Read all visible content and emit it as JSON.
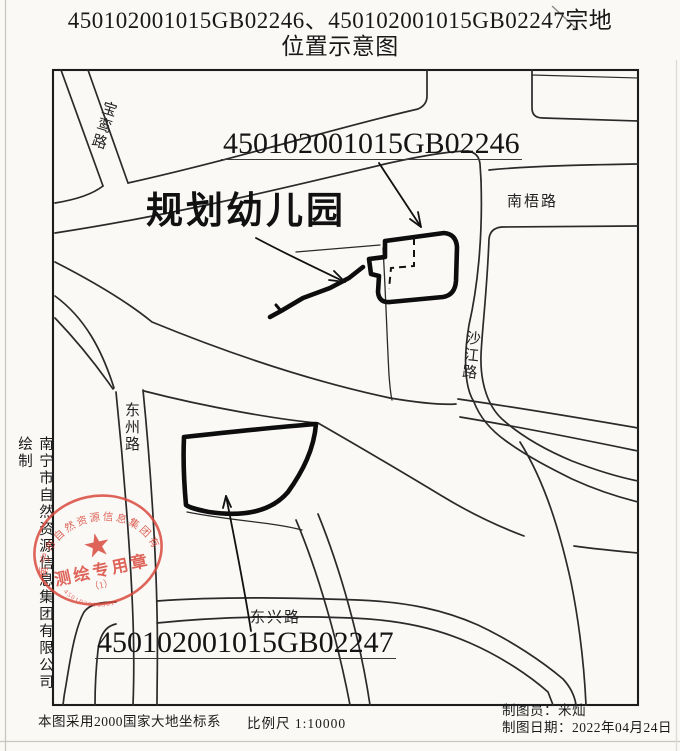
{
  "colors": {
    "ink": "#1f1f1f",
    "seal_red": "#d9473b",
    "paper": "#faf9f6"
  },
  "title": {
    "line1": "450102001015GB02246、450102001015GB02247宗地",
    "line2": "位置示意图"
  },
  "map": {
    "labels": {
      "parcel1": "450102001015GB02246",
      "kindergarten": "规划幼儿园",
      "parcel2": "450102001015GB02247"
    },
    "roads": {
      "baoluan": "宝鸾路",
      "nanwu": "南梧路",
      "shajiang": "沙江路",
      "dongzhou": "东州路",
      "dongxing": "东兴路"
    }
  },
  "seal": {
    "company": "南宁市自然资源信息集团有限公司",
    "caption": "测绘专用章",
    "index": "（1）",
    "serial": "450103016381"
  },
  "side_note": "南宁市自然资源信息集团有限公司绘制",
  "footer": {
    "datum": "本图采用2000国家大地坐标系",
    "scale": "比例尺 1:10000",
    "drafter": "制图员：米灿",
    "date": "制图日期：2022年04月24日"
  }
}
